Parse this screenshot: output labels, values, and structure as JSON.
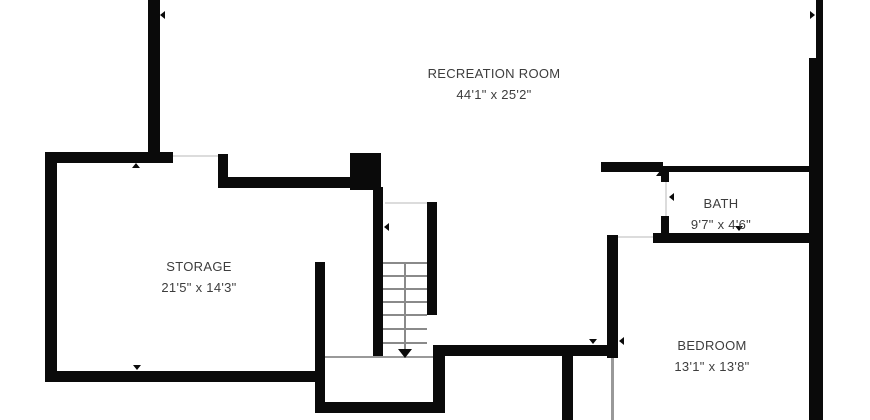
{
  "colors": {
    "wall": "#0a0a0a",
    "label_text": "#3d3d3d",
    "background": "#ffffff"
  },
  "rooms": [
    {
      "id": "recreation-room",
      "name": "RECREATION ROOM",
      "dims": "44'1\" x 25'2\""
    },
    {
      "id": "storage",
      "name": "STORAGE",
      "dims": "21'5\" x 14'3\""
    },
    {
      "id": "bath",
      "name": "BATH",
      "dims": "9'7\" x 4'6\""
    },
    {
      "id": "bedroom",
      "name": "BEDROOM",
      "dims": "13'1\" x 13'8\""
    }
  ]
}
